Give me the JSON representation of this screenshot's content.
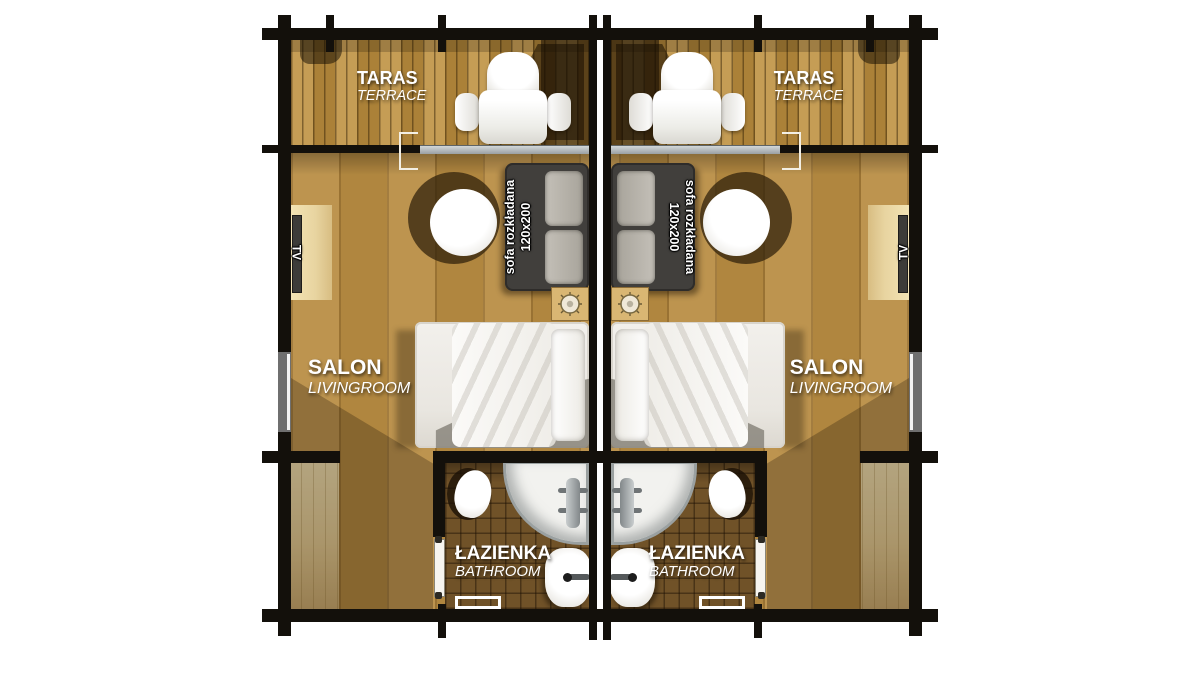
{
  "plan": {
    "type": "log-cabin duplex floor plan, two mirrored units",
    "rooms": {
      "terrace": {
        "pl": "TARAS",
        "en": "TERRACE"
      },
      "livingroom": {
        "pl": "SALON",
        "en": "LIVINGROOM"
      },
      "bathroom": {
        "pl": "ŁAZIENKA",
        "en": "BATHROOM"
      }
    },
    "furniture": {
      "sofa_line1": "sofa rozkładana",
      "sofa_line2": "120x200",
      "tv": "TV"
    },
    "colors": {
      "wall": "#13100b",
      "terrace_deck": "#b8914a",
      "salon_floor": "#b78d4b",
      "bathroom_tile": "#705228",
      "cabinet_wood": "#e8d4a0",
      "sofa": "#413f3c",
      "sofa_cushion": "#b3afa7",
      "label_text": "#ffffff"
    }
  }
}
